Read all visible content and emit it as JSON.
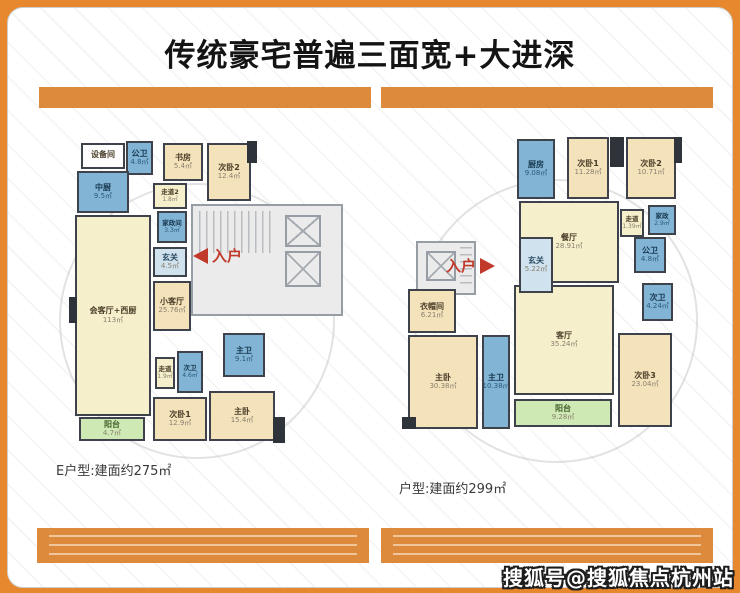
{
  "title": "传统豪宅普遍三面宽+大进深",
  "watermark": "搜狐号@搜狐焦点杭州站",
  "colors": {
    "frame_orange": "#e8882e",
    "bar_orange": "#dd8a3c",
    "entry_red": "#c0392b"
  },
  "left_plan": {
    "caption": "E户型:建面约275㎡",
    "entry_label": "入户",
    "rooms": [
      {
        "label": "设备间",
        "area": ""
      },
      {
        "label": "公卫",
        "area": "4.8㎡"
      },
      {
        "label": "书房",
        "area": "5.4㎡"
      },
      {
        "label": "次卧2",
        "area": "12.4㎡"
      },
      {
        "label": "中厨",
        "area": "9.5㎡"
      },
      {
        "label": "走道2",
        "area": "1.8㎡"
      },
      {
        "label": "家政间",
        "area": "3.3㎡"
      },
      {
        "label": "玄关",
        "area": "4.5㎡"
      },
      {
        "label": "会客厅+西厨",
        "area": "113㎡"
      },
      {
        "label": "小客厅",
        "area": "25.76㎡"
      },
      {
        "label": "主卫",
        "area": "9.1㎡"
      },
      {
        "label": "次卫",
        "area": "4.6㎡"
      },
      {
        "label": "走道",
        "area": "1.9㎡"
      },
      {
        "label": "次卧1",
        "area": "12.9㎡"
      },
      {
        "label": "主卧",
        "area": "15.4㎡"
      },
      {
        "label": "阳台",
        "area": "4.7㎡"
      }
    ]
  },
  "right_plan": {
    "caption": "户型:建面约299㎡",
    "entry_label": "入户",
    "rooms": [
      {
        "label": "厨房",
        "area": "9.08㎡"
      },
      {
        "label": "次卧1",
        "area": "11.28㎡"
      },
      {
        "label": "次卧2",
        "area": "10.71㎡"
      },
      {
        "label": "走道",
        "area": "1.39㎡"
      },
      {
        "label": "家政",
        "area": "2.9㎡"
      },
      {
        "label": "公卫",
        "area": "4.8㎡"
      },
      {
        "label": "餐厅",
        "area": "28.91㎡"
      },
      {
        "label": "玄关",
        "area": "5.22㎡"
      },
      {
        "label": "次卫",
        "area": "4.24㎡"
      },
      {
        "label": "衣帽间",
        "area": "6.21㎡"
      },
      {
        "label": "主卧",
        "area": "30.38㎡"
      },
      {
        "label": "主卫",
        "area": "10.38㎡"
      },
      {
        "label": "客厅",
        "area": "35.24㎡"
      },
      {
        "label": "阳台",
        "area": "9.28㎡"
      },
      {
        "label": "次卧3",
        "area": "23.04㎡"
      }
    ]
  }
}
